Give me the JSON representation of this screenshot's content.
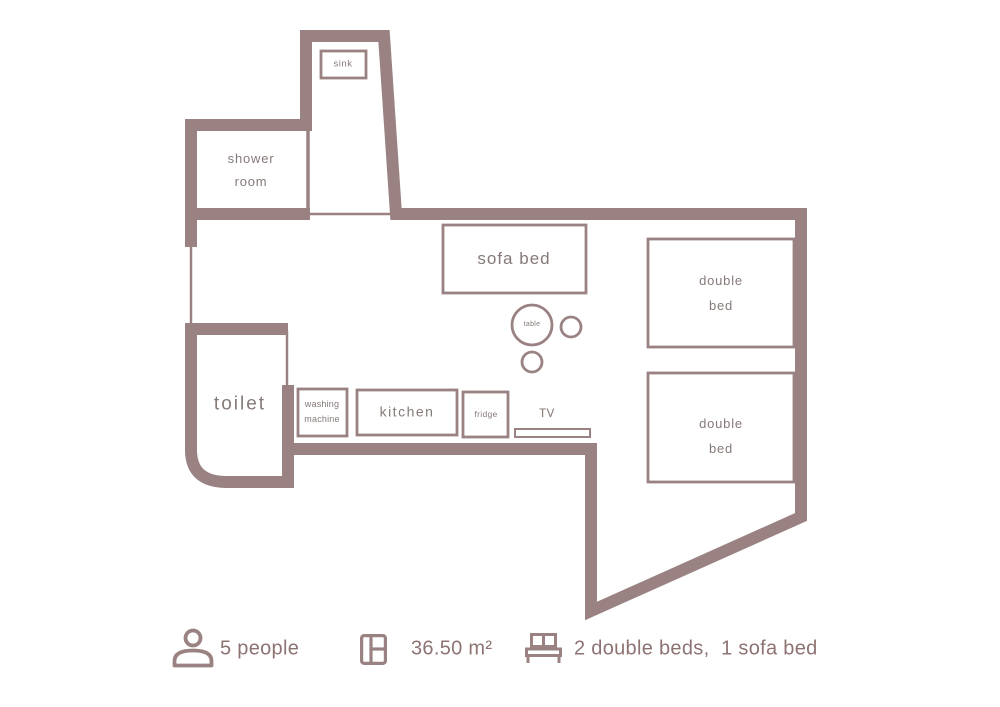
{
  "plan": {
    "rooms": {
      "sink": {
        "label": "sink"
      },
      "shower_room": {
        "line1": "shower",
        "line2": "room"
      },
      "toilet": {
        "label": "toilet"
      },
      "washing_machine": {
        "line1": "washing",
        "line2": "machine"
      },
      "kitchen": {
        "label": "kitchen"
      },
      "fridge": {
        "label": "fridge"
      },
      "tv": {
        "label": "TV"
      },
      "sofa_bed": {
        "label": "sofa bed"
      },
      "table": {
        "label": "table"
      },
      "double_bed_1": {
        "line1": "double",
        "line2": "bed"
      },
      "double_bed_2": {
        "line1": "double",
        "line2": "bed"
      }
    },
    "colors": {
      "wall": "#9a8283",
      "furniture_border": "#9a8283",
      "room_label_text": "#857a78",
      "legend_text": "#8d7473"
    }
  },
  "legend": {
    "capacity": {
      "icon": "person-icon",
      "text": "5 people"
    },
    "area": {
      "icon": "floorplan-icon",
      "text": "36.50 m²"
    },
    "beds": {
      "icon": "bed-icon",
      "text": "2 double beds,  1 sofa bed"
    }
  }
}
